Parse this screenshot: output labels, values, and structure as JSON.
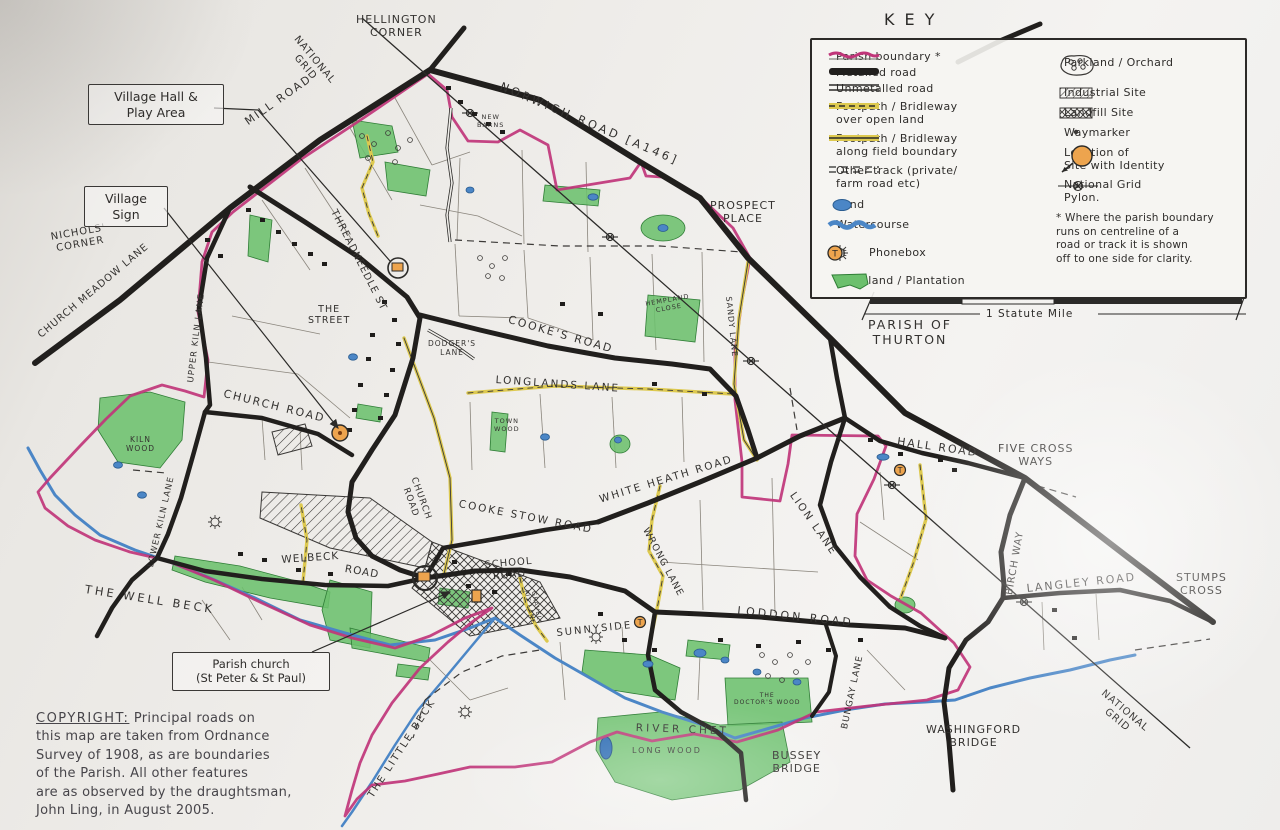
{
  "key": {
    "title": "KEY",
    "left": [
      {
        "label": "Parish boundary *"
      },
      {
        "label": "Metalled road"
      },
      {
        "label": "Unmetalled road"
      },
      {
        "label": "Footpath / Bridleway\nover open land"
      },
      {
        "label": "Footpath / Bridleway\nalong field boundary"
      },
      {
        "label": "Other track (private/\nfarm road etc)"
      },
      {
        "label": "Pond"
      },
      {
        "label": "Watercourse"
      },
      {
        "label": "Pit"
      },
      {
        "label": "Phonebox"
      },
      {
        "label": "Woodland / Plantation"
      }
    ],
    "right": [
      {
        "label": "Parkland / Orchard"
      },
      {
        "label": "Industrial Site"
      },
      {
        "label": "Landfill Site"
      },
      {
        "label": "Waymarker"
      },
      {
        "label": "Location of\nSite with Identity"
      },
      {
        "label": "National Grid\nPylon."
      }
    ],
    "note": "* Where the parish boundary\nruns on centreline of a\nroad or track it is shown\noff to one side for clarity."
  },
  "scale": {
    "label": "1 Statute Mile"
  },
  "copyright": {
    "heading": "COPYRIGHT:",
    "body": " Principal roads on\nthis map are taken from Ordnance\nSurvey of 1908, as are boundaries\nof the Parish. All other features\nare as observed by the draughtsman,\nJohn Ling, in August 2005."
  },
  "boxed_labels": [
    {
      "text": "Village Hall &\nPlay Area"
    },
    {
      "text": "Village\nSign"
    },
    {
      "text": "Parish church\n(St Peter & St Paul)"
    }
  ],
  "map_labels": [
    {
      "text": "HELLINGTON\nCORNER"
    },
    {
      "text": "NATIONAL\nGRID"
    },
    {
      "text": "MILL ROAD"
    },
    {
      "text": "NORWICH ROAD [A146]"
    },
    {
      "text": "NEW\nBARNS"
    },
    {
      "text": "PROSPECT\nPLACE"
    },
    {
      "text": "THREADNEEDLE ST"
    },
    {
      "text": "THE\nSTREET"
    },
    {
      "text": "COOKE'S ROAD"
    },
    {
      "text": "DODGER'S\nLANE"
    },
    {
      "text": "LONGLANDS LANE"
    },
    {
      "text": "HEMPLAND\nCLOSE"
    },
    {
      "text": "SANDY LANE"
    },
    {
      "text": "CHURCH ROAD"
    },
    {
      "text": "UPPER KILN LANE"
    },
    {
      "text": "KILN\nWOOD"
    },
    {
      "text": "LOWER KILN LANE"
    },
    {
      "text": "NICHOLS'\nCORNER"
    },
    {
      "text": "CHURCH MEADOW LANE"
    },
    {
      "text": "TOWN\nWOOD"
    },
    {
      "text": "COOKE STOW ROAD"
    },
    {
      "text": "CHURCH\nROAD"
    },
    {
      "text": "WHITE HEATH ROAD"
    },
    {
      "text": "WRONG LANE"
    },
    {
      "text": "LION LANE"
    },
    {
      "text": "HALL ROAD"
    },
    {
      "text": "FIVE CROSS\nWAYS"
    },
    {
      "text": "BIRCH WAY"
    },
    {
      "text": "LANGLEY ROAD"
    },
    {
      "text": "STUMPS\nCROSS"
    },
    {
      "text": "LODDON ROAD"
    },
    {
      "text": "BUNGAY LANE"
    },
    {
      "text": "SUNNYSIDE"
    },
    {
      "text": "SCHOOL\nROAD"
    },
    {
      "text": "GRAVEL\nPIT LANE"
    },
    {
      "text": "WELBECK"
    },
    {
      "text": "ROAD"
    },
    {
      "text": "THE WELL BECK"
    },
    {
      "text": "THE LITTLE BECK"
    },
    {
      "text": "RIVER CHET"
    },
    {
      "text": "LONG WOOD"
    },
    {
      "text": "THE\nDOCTOR'S WOOD"
    },
    {
      "text": "BUSSEY\nBRIDGE"
    },
    {
      "text": "WASHINGFORD\nBRIDGE"
    },
    {
      "text": "NATIONAL\nGRID"
    },
    {
      "text": "PARISH OF\nTHURTON"
    }
  ]
}
